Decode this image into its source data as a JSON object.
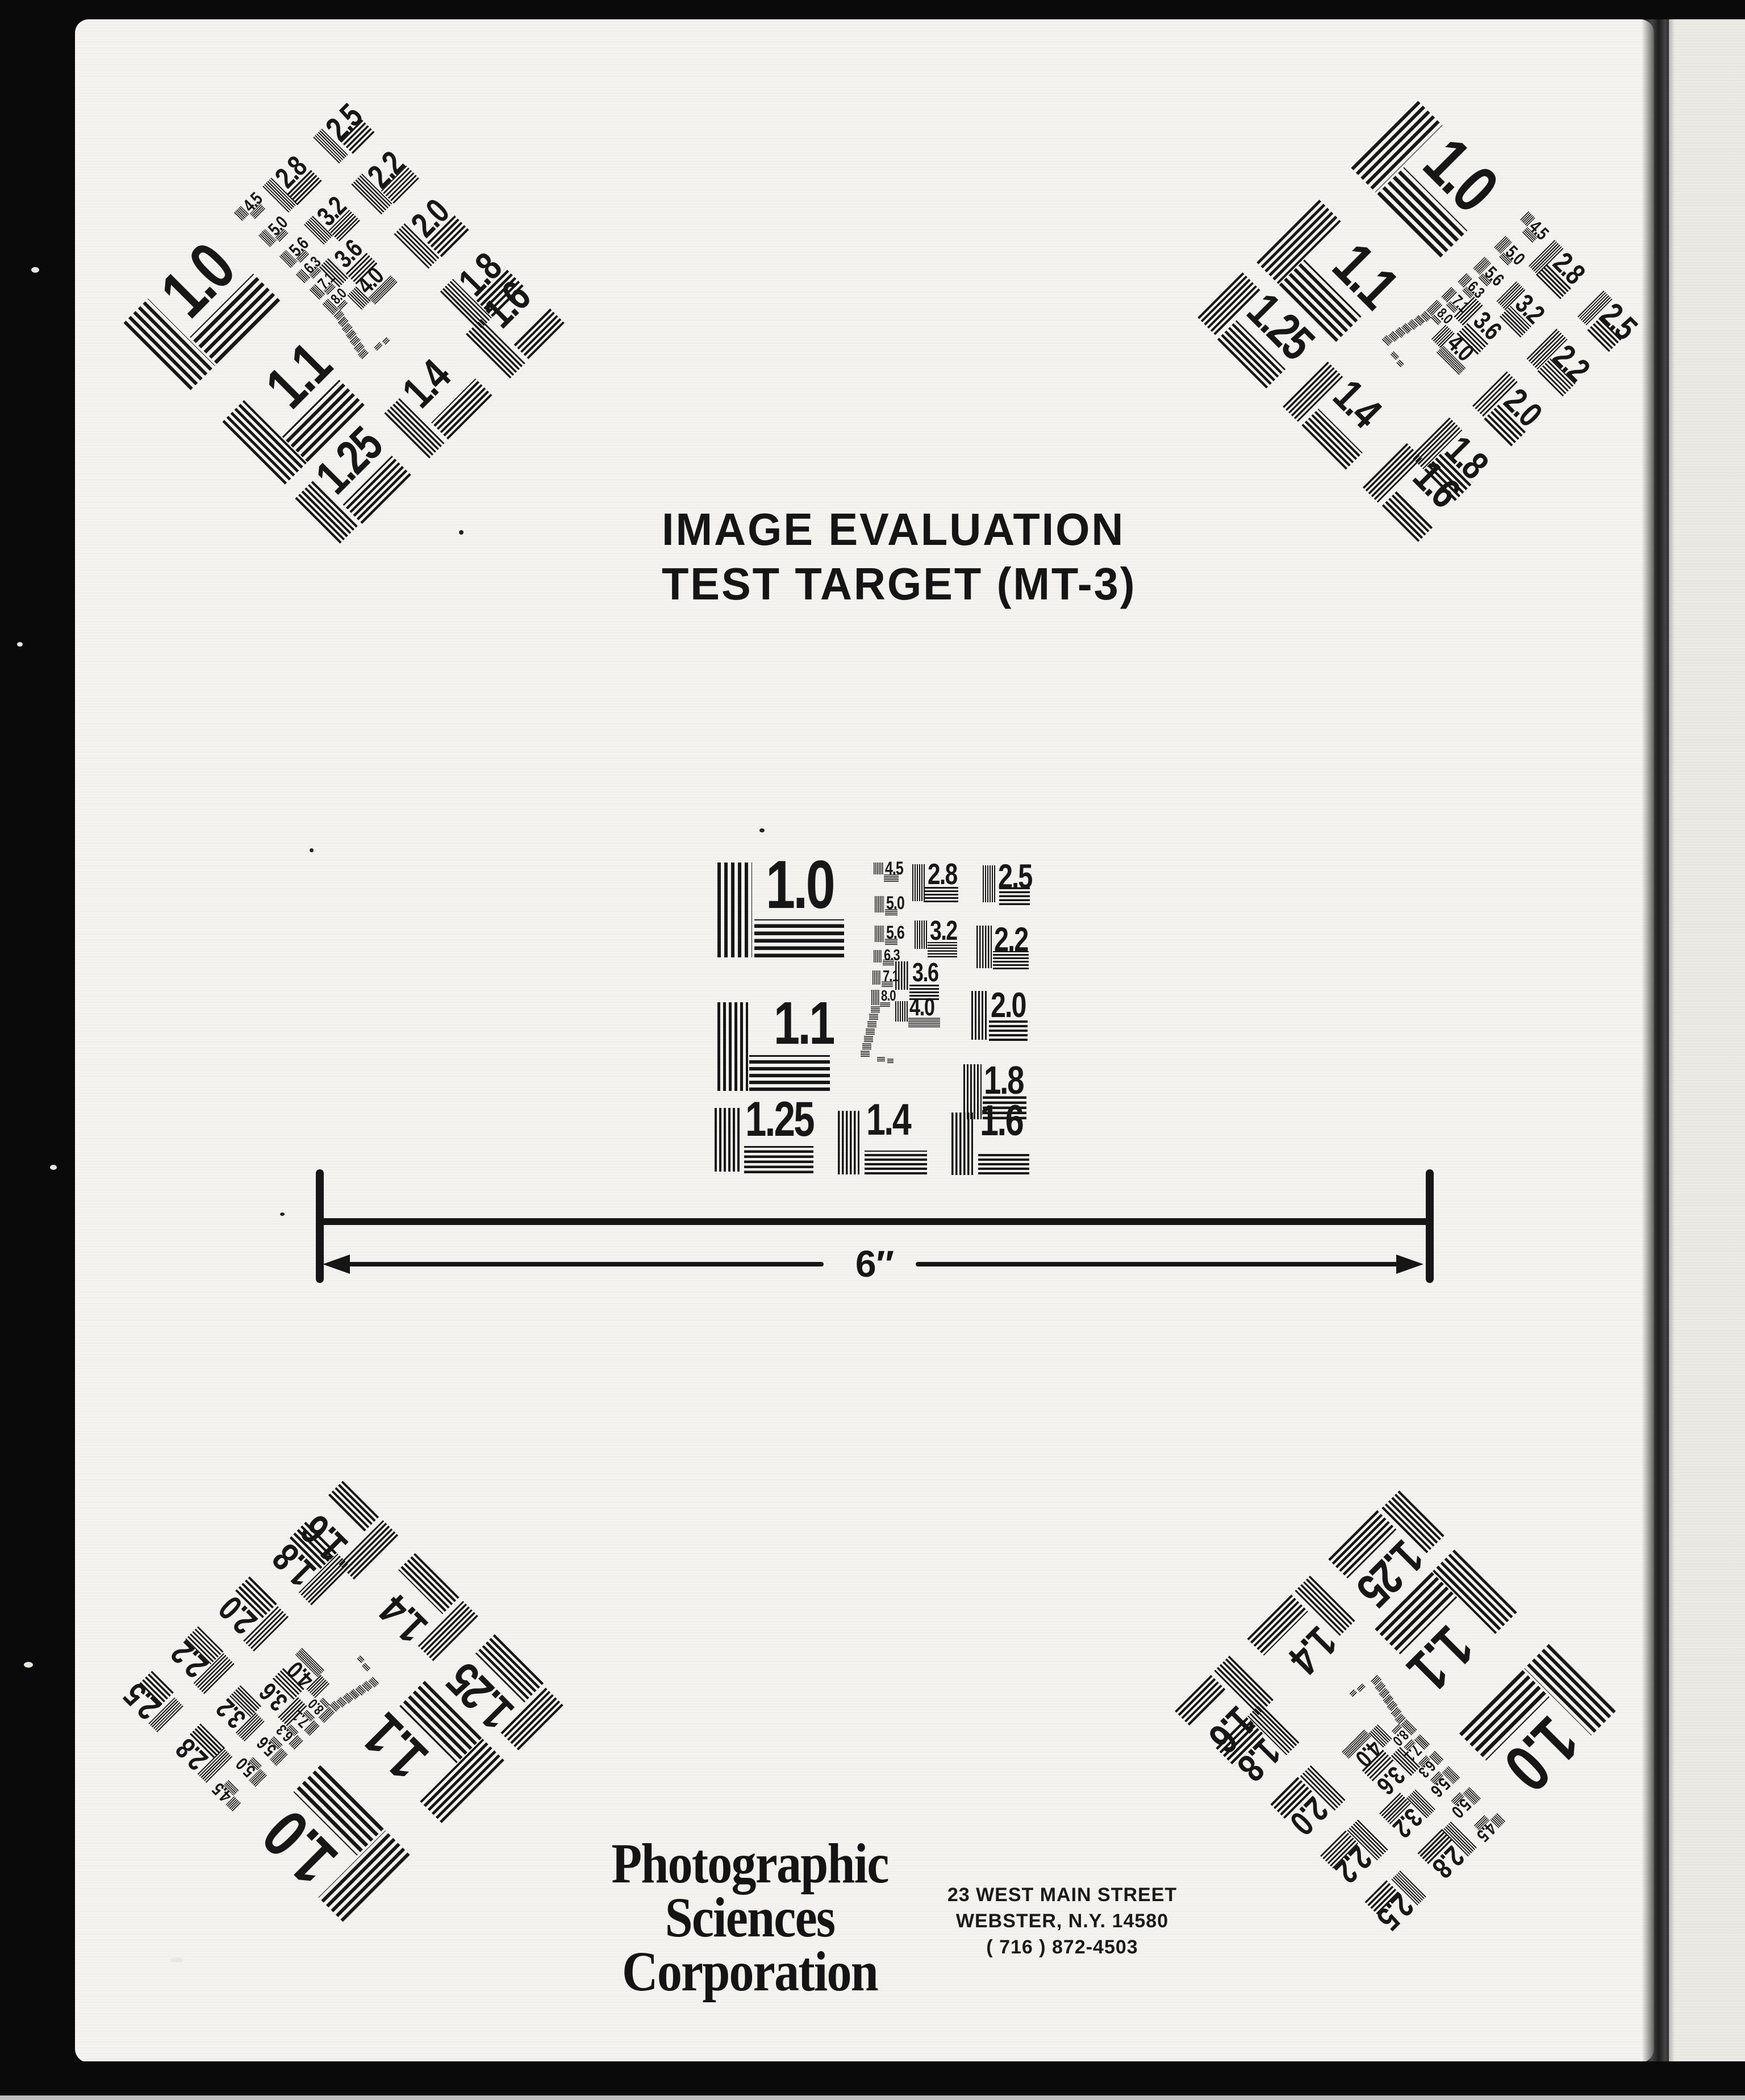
{
  "title": {
    "line1": "IMAGE EVALUATION",
    "line2": "TEST TARGET (MT-3)"
  },
  "ruler": {
    "label": "6″"
  },
  "resolution_chart": {
    "labels": [
      "1.0",
      "1.1",
      "1.25",
      "1.4",
      "1.6",
      "1.8",
      "2.0",
      "2.2",
      "2.5",
      "2.8",
      "3.2",
      "3.6",
      "4.0",
      "4.5",
      "5.0",
      "5.6",
      "6.3",
      "7.1",
      "8.0"
    ],
    "instances": [
      {
        "position": "center"
      },
      {
        "position": "top-left"
      },
      {
        "position": "top-right"
      },
      {
        "position": "bottom-left"
      },
      {
        "position": "bottom-right"
      }
    ]
  },
  "footer": {
    "company_lines": [
      "Photographic",
      "Sciences",
      "Corporation"
    ],
    "address_lines": [
      "23 WEST MAIN STREET",
      "WEBSTER, N.Y. 14580",
      "( 716 ) 872-4503"
    ]
  },
  "colors": {
    "ink": "#171717",
    "paper": "#f4f3ef",
    "paper_right_strip": "#eceae5",
    "frame": "#0a0a0a",
    "bottom_edge_line": "#bdbdbd"
  }
}
